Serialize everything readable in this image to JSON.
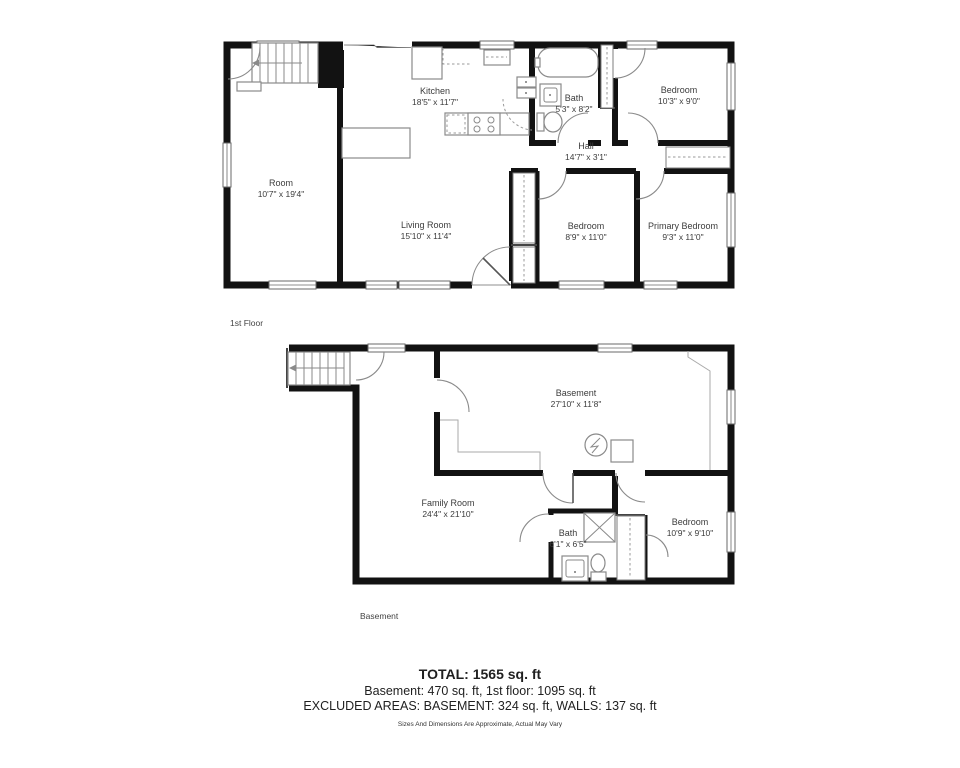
{
  "colors": {
    "walls": "#121212",
    "fixtures": "#8a8a8a"
  },
  "floors": [
    {
      "label": "1st Floor",
      "rooms": [
        {
          "name": "Kitchen",
          "dims": "18'5\" x 11'7\""
        },
        {
          "name": "Bath",
          "dims": "5'3\" x 8'2\""
        },
        {
          "name": "Bedroom",
          "dims": "10'3\" x 9'0\""
        },
        {
          "name": "Hall",
          "dims": "14'7\" x 3'1\""
        },
        {
          "name": "Room",
          "dims": "10'7\" x 19'4\""
        },
        {
          "name": "Living Room",
          "dims": "15'10\" x 11'4\""
        },
        {
          "name": "Bedroom",
          "dims": "8'9\" x 11'0\""
        },
        {
          "name": "Primary Bedroom",
          "dims": "9'3\" x 11'0\""
        }
      ]
    },
    {
      "label": "Basement",
      "rooms": [
        {
          "name": "Basement",
          "dims": "27'10\" x 11'8\""
        },
        {
          "name": "Family Room",
          "dims": "24'4\" x 21'10\""
        },
        {
          "name": "Bath",
          "dims": "6'1\" x 6'5\""
        },
        {
          "name": "Bedroom",
          "dims": "10'9\" x 9'10\""
        }
      ]
    }
  ],
  "summary": {
    "total": "TOTAL: 1565 sq. ft",
    "floors_line": "Basement: 470 sq. ft, 1st floor: 1095 sq. ft",
    "excluded_line": "EXCLUDED AREAS: BASEMENT: 324 sq. ft, WALLS: 137 sq. ft",
    "disclaimer": "Sizes And Dimensions Are Approximate, Actual May Vary"
  }
}
